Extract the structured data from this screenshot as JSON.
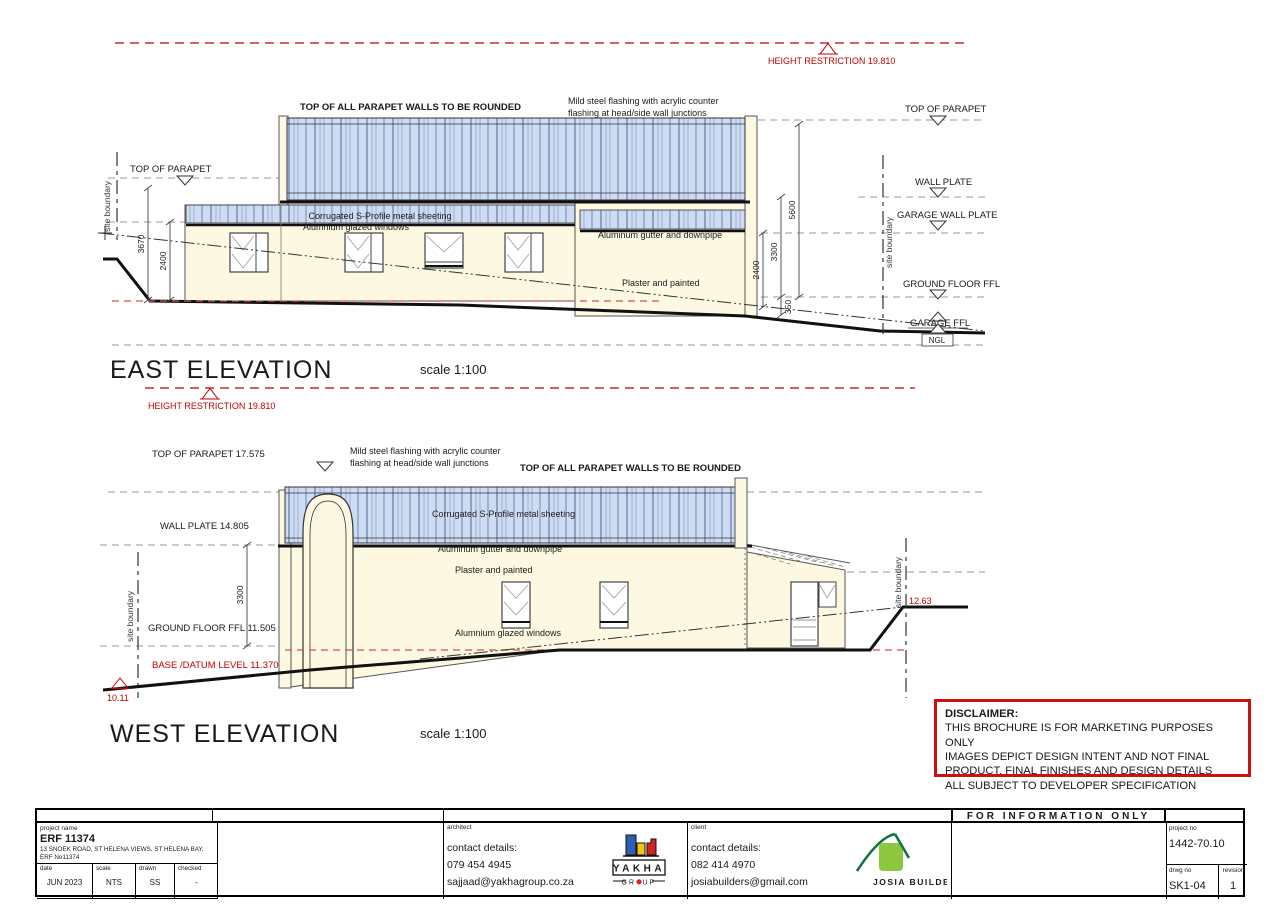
{
  "colors": {
    "wall": "#fdf8e1",
    "sheeting": "#cddcf3",
    "restriction_red": "#c00000",
    "base_red": "#cc5555"
  },
  "east": {
    "title": "EAST ELEVATION",
    "scale": "scale 1:100",
    "height_restriction_top": "HEIGHT RESTRICTION 19.810",
    "height_restriction_bottom": "HEIGHT RESTRICTION 19.810",
    "parapet_note": "TOP OF ALL PARAPET WALLS TO BE ROUNDED",
    "flashing_note_1": "Mild steel flashing with acrylic counter",
    "flashing_note_2": "flashing at head/side wall junctions",
    "sheeting_label": "Corrugated S-Profile metal sheeting",
    "windows_label": "Alumnium glazed windows",
    "gutter_label": "Aluminum gutter and downpipe",
    "plaster_label": "Plaster and painted",
    "site_boundary_left": "site boundary",
    "site_boundary_right": "site boundary",
    "top_of_parapet_left": "TOP OF PARAPET",
    "levels_right": {
      "top_of_parapet": "TOP OF PARAPET",
      "wall_plate": "WALL PLATE",
      "garage_wall_plate": "GARAGE WALL PLATE",
      "ground_floor_ffl": "GROUND FLOOR FFL",
      "garage_ffl": "GARAGE FFL",
      "ngl": "NGL"
    },
    "dims": {
      "left_outer": "3670",
      "left_inner": "2400",
      "right_inner": "2400",
      "right_mid": "3300",
      "right_outer": "5600",
      "right_small": "350"
    }
  },
  "west": {
    "title": "WEST ELEVATION",
    "scale": "scale 1:100",
    "parapet_note": "TOP OF ALL PARAPET WALLS TO BE ROUNDED",
    "flashing_note_1": "Mild steel flashing with acrylic counter",
    "flashing_note_2": "flashing at head/side wall junctions",
    "sheeting_label": "Corrugated S-Profile metal sheeting",
    "gutter_label": "Aluminum gutter and downpipe",
    "plaster_label": "Plaster and painted",
    "windows_label": "Alumnium glazed windows",
    "levels_left": {
      "top_of_parapet": "TOP OF PARAPET 17.575",
      "wall_plate": "WALL PLATE 14.805",
      "ground_floor_ffl": "GROUND FLOOR FFL 11.505",
      "base_datum": "BASE /DATUM LEVEL 11.370"
    },
    "dim_3300": "3300",
    "site_boundary_left": "site boundary",
    "site_boundary_right": "site boundary",
    "spot_left": "10.11",
    "spot_right": "12.63"
  },
  "disclaimer": {
    "heading": "DISCLAIMER:",
    "line1": "THIS BROCHURE IS FOR MARKETING PURPOSES ONLY",
    "line2": "IMAGES DEPICT DESIGN INTENT AND NOT FINAL",
    "line3": "PRODUCT. FINAL FINISHES AND DESIGN DETAILS",
    "line4": "ALL SUBJECT TO DEVELOPER SPECIFICATION"
  },
  "titleblock": {
    "for_information": "FOR INFORMATION ONLY",
    "project": {
      "label": "project name",
      "name": "ERF 11374",
      "address": "13 SNOEK ROAD, ST HELENA VIEWS, ST HELENA BAY,",
      "erf": "ERF No11374",
      "date_label": "date",
      "date": "JUN 2023",
      "scale_label": "scale",
      "scale": "NTS",
      "drawn_label": "drawn",
      "drawn": "SS",
      "checked_label": "checked",
      "checked": "-"
    },
    "architect": {
      "label": "architect",
      "contact": "contact details:",
      "phone": "079 454 4945",
      "email": "sajjaad@yakhagroup.co.za"
    },
    "client": {
      "label": "client",
      "contact": "contact details:",
      "phone": "082 414 4970",
      "email": "josiabuilders@gmail.com"
    },
    "yakha_logo": {
      "name": "YAKHA",
      "sub_left": "GR",
      "sub_right": "UP"
    },
    "josia_logo": {
      "name": "JOSIA BUILDERS"
    },
    "project_no_label": "project no",
    "project_no": "1442-70.10",
    "drwg_no_label": "drwg no",
    "drwg_no": "SK1-04",
    "revision_label": "revision",
    "revision": "1"
  }
}
